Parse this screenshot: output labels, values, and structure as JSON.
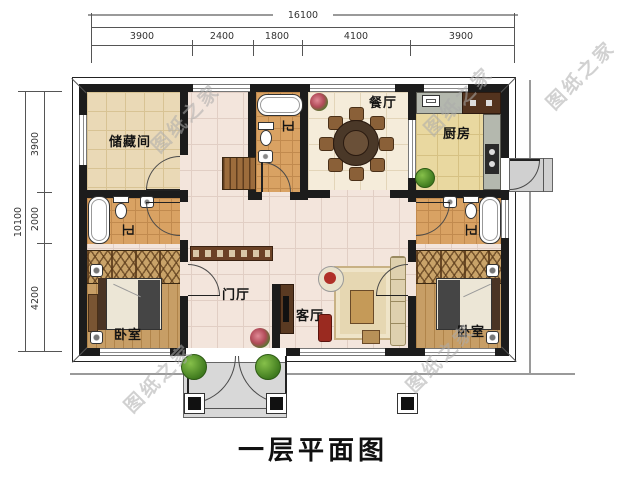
{
  "plan": {
    "title": "一层平面图"
  },
  "watermark": {
    "text": "图纸之家"
  },
  "dimensions": {
    "top": {
      "total": "16100",
      "segments": [
        "3900",
        "2400",
        "1800",
        "4100",
        "3900"
      ]
    },
    "left": {
      "total": "10100",
      "segments": [
        "3900",
        "2000",
        "4200"
      ]
    }
  },
  "rooms": {
    "storage": "储藏间",
    "bath": "卫",
    "dining": "餐厅",
    "kitchen": "厨房",
    "foyer": "门厅",
    "living": "客厅",
    "bedroom": "卧室"
  }
}
